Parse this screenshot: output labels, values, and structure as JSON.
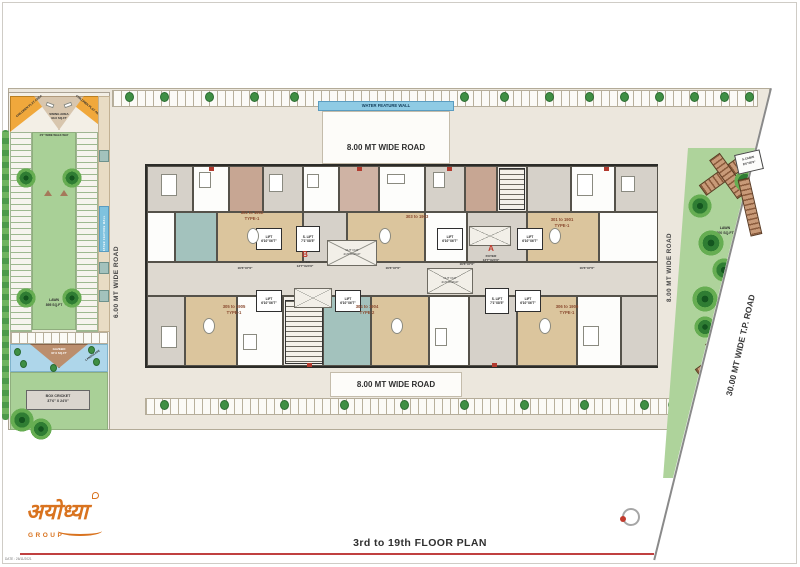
{
  "meta": {
    "title": "3rd to 19th FLOOR PLAN",
    "date_note": "DATE : 26/11/2021"
  },
  "logo": {
    "brand": "अयोध्या",
    "group": "GROUP"
  },
  "roads": {
    "top": "8.00 MT WIDE ROAD",
    "bottom": "8.00 MT WIDE ROAD",
    "left": "6.00 MT WIDE ROAD",
    "right": "8.00 MT WIDE ROAD",
    "tp": "30.00 MT WIDE T.P. ROAD",
    "water_feature_wall": "WATER FEATURE WALL"
  },
  "left_garden": {
    "children_play_left": "CHILDREN PLAY AREA",
    "children_play_right": "CHILDREN PLAY AREA",
    "swing_area": "SWING AREA",
    "swing_area_size": "93.0 SQ.FT",
    "walkway": "4'0\" WIDE WALK WAY",
    "water_wall": "WATER FEATURE WALL",
    "lawn": "LAWN",
    "lawn_size": "895 SQ.FT",
    "gazebo": "GAZEBO",
    "gazebo_size": "97.0 SQ.FT",
    "landscape": "LANDSCAPE",
    "box_cricket": "BOX CRICKET",
    "box_cricket_size": "37'6\" X 24'0\""
  },
  "right_garden": {
    "s_cabin": "S.CABIN",
    "s_cabin_size": "8'6\"X6'0\"",
    "lawn": "LAWN",
    "lawn_size": "600 SQ.FT",
    "sitting_top": "SITTING AREA",
    "sitting_bottom": "SITTING AREA"
  },
  "building": {
    "tower_a": "A",
    "tower_b": "B",
    "foyer": "FOYER",
    "foyer_size": "13'7\"X24'6\"",
    "lift": "LIFT",
    "lift_size": "6'10\"X6'7\"",
    "s_lift": "S. LIFT",
    "s_lift_size": "7'1\"X8'5\"",
    "cut_out": "CUT OUT",
    "cut_out_size": "21'0\"X10'10\"",
    "passage_size": "16'6\"X7'6\"",
    "units": [
      {
        "label": "302 to 1902",
        "type": "TYPE-1"
      },
      {
        "label": "303 to 1903",
        "type": ""
      },
      {
        "label": "301 to 1901",
        "type": "TYPE-1"
      },
      {
        "label": "305 to 1905",
        "type": "TYPE-1"
      },
      {
        "label": "304 to 1904",
        "type": "TYPE-2"
      },
      {
        "label": "306 to 1906",
        "type": "TYPE-1"
      }
    ]
  },
  "colors": {
    "accent_red": "#c0392b",
    "logo_orange": "#d9731f",
    "lawn_green": "#a9d097",
    "water_blue": "#aed6ea",
    "play_orange": "#f0a83c",
    "site_beige": "#ece7dd"
  }
}
